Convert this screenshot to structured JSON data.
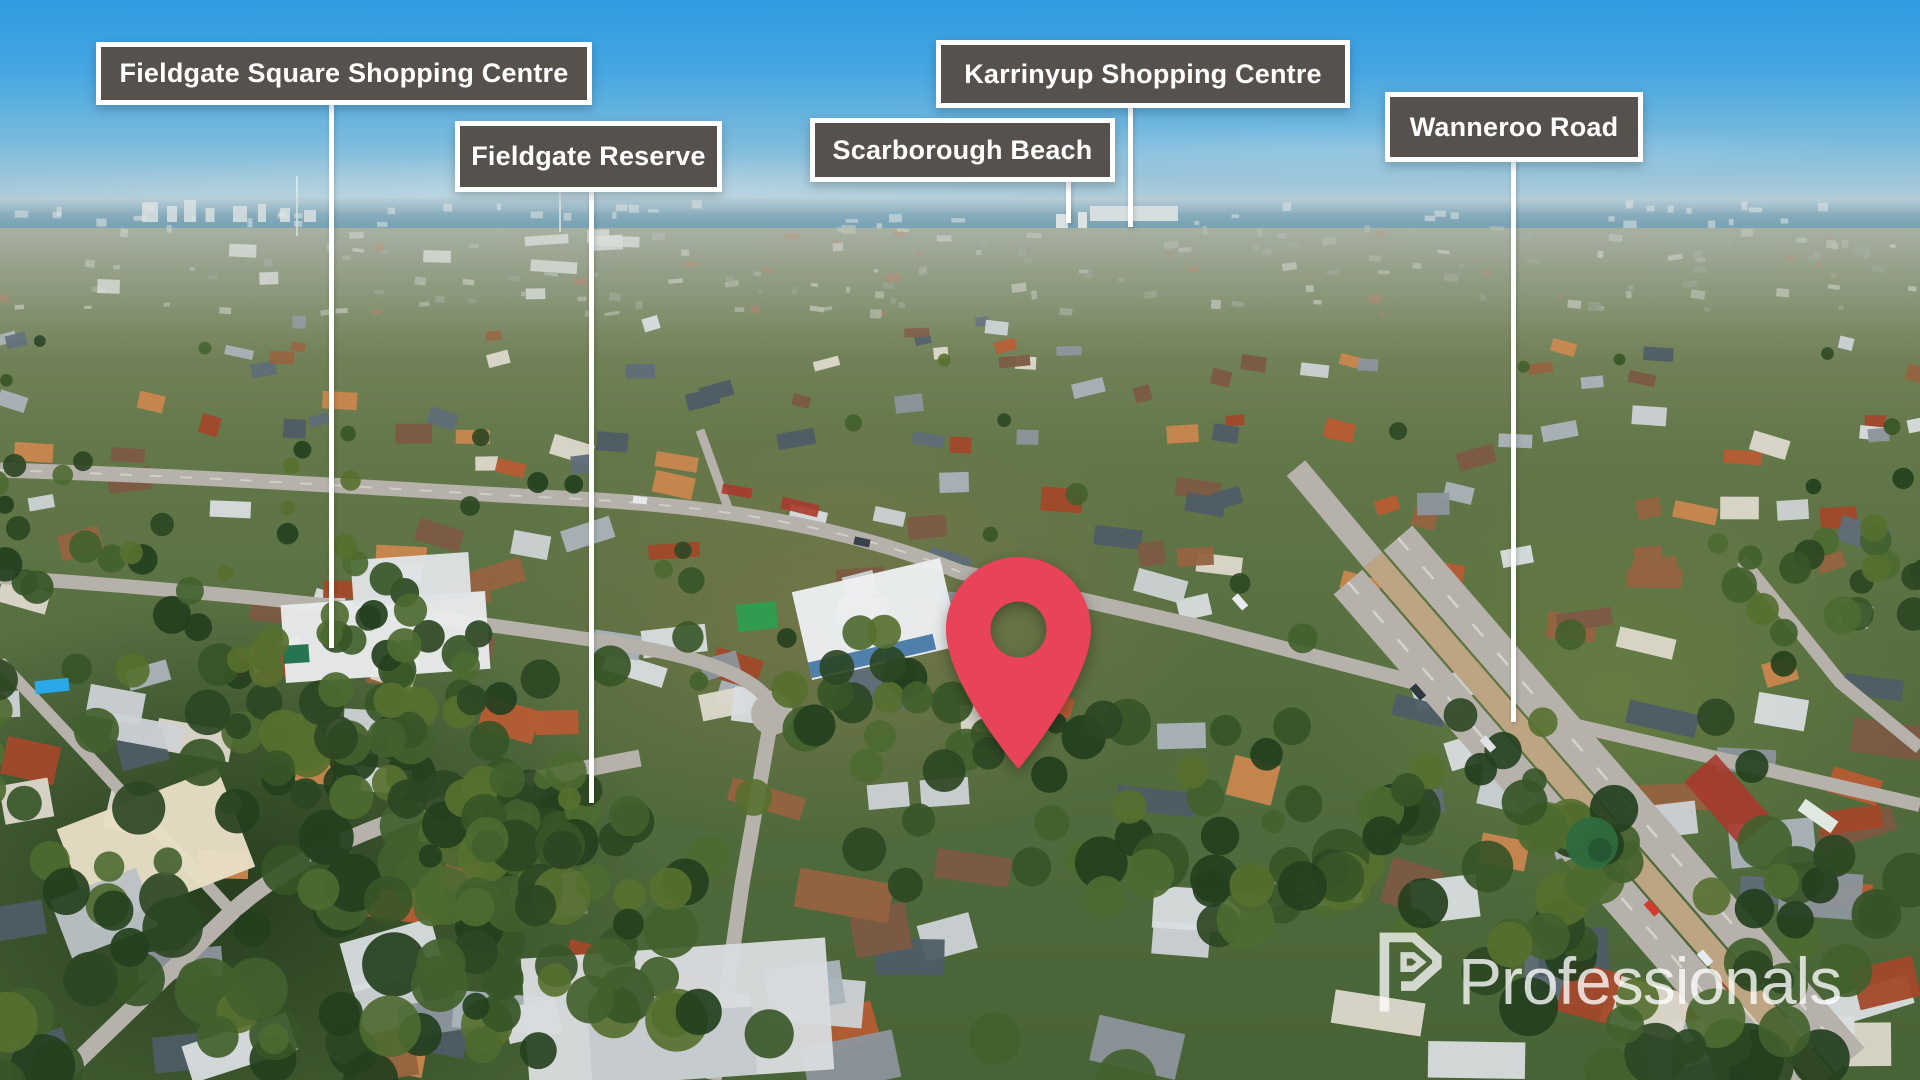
{
  "page": {
    "width": 1920,
    "height": 1080,
    "alt": "Aerial drone photograph of a coastal suburb with landmark callout labels, a red location pin and a Professionals watermark"
  },
  "labels": [
    {
      "id": "fieldgate-square-shopping-centre",
      "text": "Fieldgate Square Shopping Centre",
      "box": {
        "left": 96,
        "top": 42,
        "width": 496,
        "height": 63
      },
      "line": {
        "x": 331,
        "y1": 104,
        "y2": 648
      }
    },
    {
      "id": "fieldgate-reserve",
      "text": "Fieldgate Reserve",
      "box": {
        "left": 455,
        "top": 121,
        "width": 267,
        "height": 71
      },
      "line": {
        "x": 591,
        "y1": 190,
        "y2": 803
      }
    },
    {
      "id": "scarborough-beach",
      "text": "Scarborough Beach",
      "box": {
        "left": 810,
        "top": 118,
        "width": 305,
        "height": 64
      },
      "line": {
        "x": 1068,
        "y1": 180,
        "y2": 223
      }
    },
    {
      "id": "karrinyup-shopping-centre",
      "text": "Karrinyup Shopping Centre",
      "box": {
        "left": 936,
        "top": 40,
        "width": 414,
        "height": 68
      },
      "line": {
        "x": 1130,
        "y1": 106,
        "y2": 227
      }
    },
    {
      "id": "wanneroo-road",
      "text": "Wanneroo Road",
      "box": {
        "left": 1385,
        "top": 92,
        "width": 258,
        "height": 70
      },
      "line": {
        "x": 1513,
        "y1": 160,
        "y2": 722
      }
    }
  ],
  "marker": {
    "color": "#E9435A",
    "x": 1018,
    "top": 553,
    "width": 153,
    "height": 220
  },
  "watermark": {
    "brand": "Professionals"
  },
  "palette": {
    "label_bg": "#57514E",
    "label_border": "#FFFFFF",
    "label_text": "#FFFFFF",
    "pointer_line": "#FFFFFF",
    "sky_top": "#379FE3",
    "ocean": "#4E87A3",
    "road": "#B6B2AB",
    "median": "#BDA584",
    "red_asphalt": "#A83A2C",
    "pin": "#E9435A",
    "roof_colors": [
      "#cdd2d6",
      "#aab3ba",
      "#5f6d79",
      "#b65c33",
      "#a2482a",
      "#ddd8cc",
      "#8c959c",
      "#4e5d66",
      "#c9874e",
      "#95633f",
      "#d9dde0",
      "#7c5a43"
    ],
    "tree_colors": [
      "#2c4724",
      "#375527",
      "#42612c",
      "#4d6a30",
      "#243f1e",
      "#56702f"
    ]
  }
}
